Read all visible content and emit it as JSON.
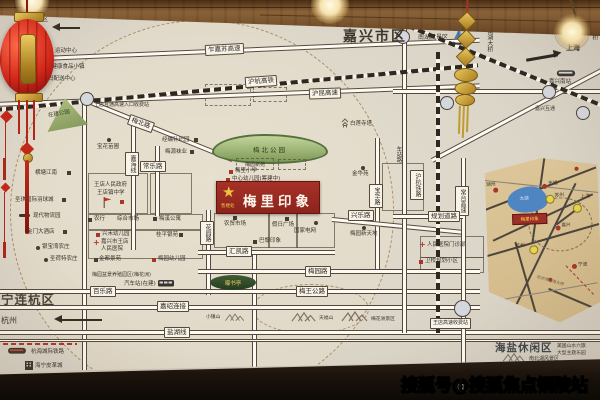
{
  "watermark": "搜狐号@搜狐焦点铜陵站",
  "title": {
    "city_area": "嘉兴市区"
  },
  "areas": {
    "ninglianhang": "宁连杭区",
    "haiyan_leisure": "海盐休闲区",
    "mingzhen_scenic": "名镇景区",
    "hangzhou": "杭州",
    "shanghai": "上海"
  },
  "project": {
    "name": "梅里印象",
    "sales_office": "售楼处"
  },
  "roads": {
    "zhajiasu": "乍嘉苏高速",
    "huhang_hsr": "沪杭高铁",
    "hukun": "沪昆高速",
    "meibei": "梅北路",
    "changle": "常乐路",
    "jiahai": "嘉海线",
    "baohua": "宝华路",
    "xingle": "兴乐路",
    "huayuan": "花园路",
    "huikai": "汇凯路",
    "meiyuan": "梅园路",
    "meiwang": "梅王公路",
    "baile": "百乐路",
    "jiashao": "嘉绍连接",
    "yanhu": "盐湖线",
    "guihua": "规划道路",
    "huhang_rail": "沪杭铁路",
    "changtai": "常台高速",
    "chezhan": "车站路"
  },
  "transit": {
    "bus_station": "汽车站(在建)",
    "jiaxing_south_station": "嘉兴南站",
    "jiaxing_interchange": "嘉兴互通",
    "nanhu_bridge": "南湖大桥",
    "cross_sea_bridge": "跨海大桥",
    "toll_gate": "王店高速收费站",
    "toll_entry": "王店互通高速入口收费站",
    "hanghai_rail": "杭海城际铁路"
  },
  "parks": {
    "meibei_park": "梅北公园",
    "park_under_construction": "在建公园",
    "pushuting": "曝书亭"
  },
  "mountains": {
    "xiaozhen": "小镇山",
    "tianfu": "天福山",
    "meihuazhou": "梅花洲景区"
  },
  "scenic": {
    "nanhu": "南湖风景区",
    "nanbeihu": "南北湖风景区",
    "six_flags_line1": "美国山水六旗",
    "six_flags_line2": "大型主题乐园",
    "penjing_garden": "梅园盆景养殖园区(梅花洲)",
    "majiabang": "马家浜健康食品小镇",
    "bailian_pagoda": "白莲寺塔"
  },
  "pois": {
    "sports_center": "运动中心",
    "walmart_dc": "沃尔玛配送中心",
    "baohua_nursery": "宝花苗圃",
    "knitting_park": "经编针织园",
    "meiyuan_socks": "梅源袜业",
    "hengtang": "横塘江南",
    "shengqi": "圣琪国际羽球城",
    "logistics": "现代物流园",
    "jinmen_hotel": "金门大酒店",
    "yinbaowan": "银宝湾农庄",
    "shenghete": "圣荷特农庄",
    "wangdian_gov": "王店人民政府",
    "wangdian_school": "王店镇中学",
    "abc_bank": "农行",
    "market": "综合市场",
    "meixi_apartments": "梅溪公寓",
    "xinghe_kindergarten": "兴禾幼儿园",
    "hospital_line1": "嘉兴市王店",
    "hospital_line2": "人民医院",
    "guiping": "桂平银苑",
    "jindu": "金都景苑",
    "meiyuan_kindergarten": "梅园幼儿园",
    "meiyuan_xinyuan": "梅园新苑",
    "meili_primary": "梅里小学",
    "central_kindergarten": "中心幼儿园(筹建中)",
    "jinhua_yuan": "金华苑",
    "holiday_plaza": "假日广场",
    "farmers_market": "农贸市场",
    "state_grid": "国家电网",
    "paris_impression": "巴黎印象",
    "meiyuan_xintiandi": "梅园新天地",
    "clinic": "人民医院门诊部",
    "weixiao": "卫校规划小区",
    "leather_city": "海宁皮革城"
  },
  "inset": {
    "cities": {
      "huzhou": "湖州",
      "wuxi": "无锡",
      "suzhou": "苏州",
      "shanghai": "上海",
      "jiaxing": "嘉兴",
      "hangzhou": "杭州",
      "ningbo": "宁波"
    },
    "lake": "太湖",
    "project": "梅里印象",
    "bridge": "杭州湾跨海大桥"
  },
  "icons": {
    "star": "★",
    "dot": "●",
    "square": "■",
    "cross": "+"
  },
  "colors": {
    "project_red": "#9e2f26",
    "park_green": "#8fa45f",
    "inset_tan": "#d8c193",
    "lake_blue": "#5b8fc9",
    "gold": "#f2c23e"
  }
}
